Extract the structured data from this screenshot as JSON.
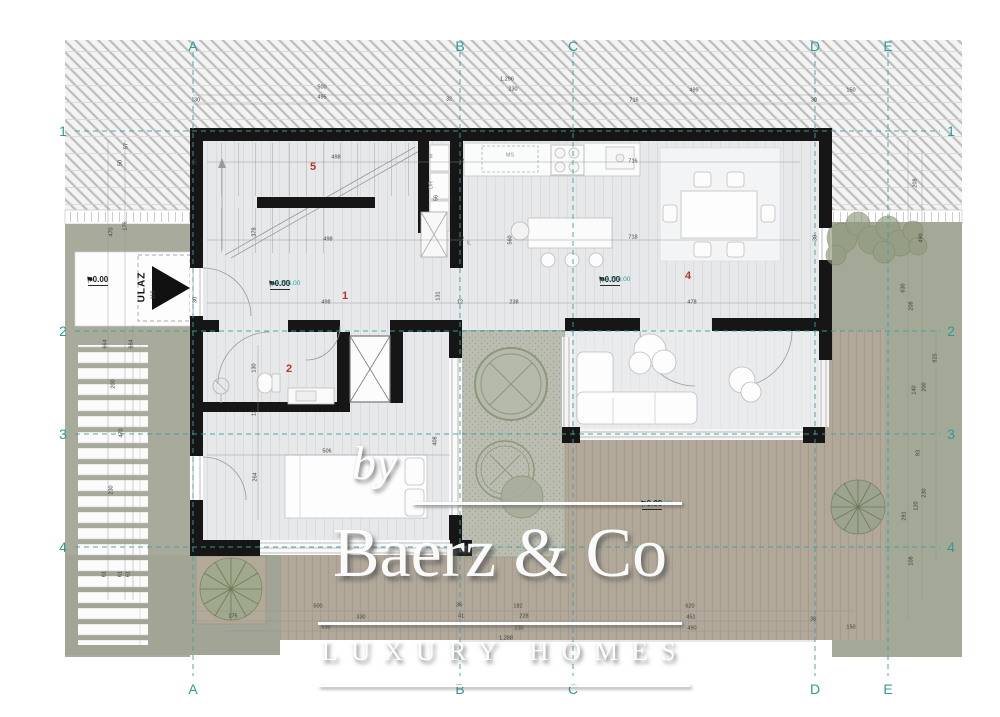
{
  "watermark": {
    "by": "by",
    "brand": "Baerz & Co",
    "tagline": "LUXURY HOMES"
  },
  "colors": {
    "grid_teal": "#2d9c96",
    "room_red": "#b0392f",
    "wall_black": "#161616",
    "grass": "#a8ab9b",
    "deck_tan": "#b2a89a",
    "floor_gray": "#e7e8ea",
    "elevation_teal": "#2d9c96"
  },
  "grid": {
    "top_y": 46,
    "bottom_y": 689,
    "left_x": 63,
    "right_x": 951,
    "columns": [
      {
        "label": "A",
        "x": 193
      },
      {
        "label": "B",
        "x": 460
      },
      {
        "label": "C",
        "x": 573
      },
      {
        "label": "D",
        "x": 815
      },
      {
        "label": "E",
        "x": 888
      }
    ],
    "rows": [
      {
        "label": "1",
        "y": 131
      },
      {
        "label": "2",
        "y": 331
      },
      {
        "label": "3",
        "y": 434
      },
      {
        "label": "4",
        "y": 547
      }
    ]
  },
  "entrance": {
    "label": "ULAZ",
    "x": 142,
    "y": 287
  },
  "room_numbers": [
    {
      "number": "5",
      "x": 313,
      "y": 167
    },
    {
      "number": "1",
      "x": 345,
      "y": 296
    },
    {
      "number": "2",
      "x": 289,
      "y": 369
    },
    {
      "number": "4",
      "x": 688,
      "y": 276
    }
  ],
  "elevation_markers": [
    {
      "value": "+0.00",
      "sub": "",
      "x": 86,
      "y": 276
    },
    {
      "value": "+0.00",
      "sub": "a.k.216.00",
      "x": 268,
      "y": 280
    },
    {
      "value": "+0.00",
      "sub": "a.k.216.00",
      "x": 598,
      "y": 276
    },
    {
      "value": "+0.00",
      "sub": "a.k.216.00",
      "x": 640,
      "y": 500
    }
  ],
  "small_labels": [
    {
      "t": "MS",
      "x": 510,
      "y": 156
    },
    {
      "t": "W",
      "x": 432,
      "y": 156,
      "rot": 1
    },
    {
      "t": "DR",
      "x": 432,
      "y": 185,
      "rot": 1
    },
    {
      "t": "IL",
      "x": 469,
      "y": 244
    }
  ],
  "dimensions": [
    {
      "t": "1,296",
      "x": 507,
      "y": 80
    },
    {
      "t": "230",
      "x": 513,
      "y": 90
    },
    {
      "t": "500",
      "x": 322,
      "y": 88
    },
    {
      "t": "495",
      "x": 322,
      "y": 98
    },
    {
      "t": "30",
      "x": 197,
      "y": 101
    },
    {
      "t": "32",
      "x": 449,
      "y": 100
    },
    {
      "t": "716",
      "x": 634,
      "y": 101
    },
    {
      "t": "499",
      "x": 694,
      "y": 91
    },
    {
      "t": "30",
      "x": 814,
      "y": 101
    },
    {
      "t": "150",
      "x": 851,
      "y": 91
    },
    {
      "t": "57",
      "x": 127,
      "y": 146,
      "rot": 1
    },
    {
      "t": "50",
      "x": 121,
      "y": 163,
      "rot": 1
    },
    {
      "t": "176",
      "x": 126,
      "y": 226,
      "rot": 1
    },
    {
      "t": "470",
      "x": 112,
      "y": 232,
      "rot": 1
    },
    {
      "t": "110",
      "x": 154,
      "y": 295,
      "rot": 1
    },
    {
      "t": "664",
      "x": 106,
      "y": 344,
      "rot": 1
    },
    {
      "t": "664",
      "x": 132,
      "y": 344,
      "rot": 1
    },
    {
      "t": "200",
      "x": 114,
      "y": 384,
      "rot": 1
    },
    {
      "t": "470",
      "x": 122,
      "y": 433,
      "rot": 1
    },
    {
      "t": "230",
      "x": 112,
      "y": 490,
      "rot": 1
    },
    {
      "t": "61",
      "x": 105,
      "y": 574,
      "rot": 1
    },
    {
      "t": "61",
      "x": 121,
      "y": 574,
      "rot": 1
    },
    {
      "t": "61",
      "x": 129,
      "y": 574,
      "rot": 1
    },
    {
      "t": "208",
      "x": 916,
      "y": 183,
      "rot": 1
    },
    {
      "t": "490",
      "x": 922,
      "y": 238,
      "rot": 1
    },
    {
      "t": "630",
      "x": 904,
      "y": 288,
      "rot": 1
    },
    {
      "t": "208",
      "x": 912,
      "y": 306,
      "rot": 1
    },
    {
      "t": "925",
      "x": 936,
      "y": 358,
      "rot": 1
    },
    {
      "t": "140",
      "x": 915,
      "y": 390,
      "rot": 1
    },
    {
      "t": "200",
      "x": 925,
      "y": 387,
      "rot": 1
    },
    {
      "t": "93",
      "x": 919,
      "y": 453,
      "rot": 1
    },
    {
      "t": "230",
      "x": 925,
      "y": 493,
      "rot": 1
    },
    {
      "t": "120",
      "x": 917,
      "y": 506,
      "rot": 1
    },
    {
      "t": "291",
      "x": 905,
      "y": 516,
      "rot": 1
    },
    {
      "t": "108",
      "x": 912,
      "y": 561,
      "rot": 1
    },
    {
      "t": "500",
      "x": 318,
      "y": 607
    },
    {
      "t": "36",
      "x": 459,
      "y": 606
    },
    {
      "t": "182",
      "x": 518,
      "y": 607
    },
    {
      "t": "620",
      "x": 690,
      "y": 607
    },
    {
      "t": "175",
      "x": 233,
      "y": 617
    },
    {
      "t": "330",
      "x": 361,
      "y": 618
    },
    {
      "t": "41",
      "x": 461,
      "y": 617
    },
    {
      "t": "228",
      "x": 524,
      "y": 617
    },
    {
      "t": "451",
      "x": 691,
      "y": 618
    },
    {
      "t": "530",
      "x": 326,
      "y": 628
    },
    {
      "t": "230",
      "x": 519,
      "y": 629
    },
    {
      "t": "490",
      "x": 692,
      "y": 629
    },
    {
      "t": "1,288",
      "x": 506,
      "y": 639
    },
    {
      "t": "38",
      "x": 813,
      "y": 620
    },
    {
      "t": "150",
      "x": 851,
      "y": 628
    },
    {
      "t": "498",
      "x": 336,
      "y": 158
    },
    {
      "t": "12",
      "x": 461,
      "y": 162
    },
    {
      "t": "716",
      "x": 633,
      "y": 162
    },
    {
      "t": "718",
      "x": 633,
      "y": 238
    },
    {
      "t": "560",
      "x": 511,
      "y": 240,
      "rot": 1
    },
    {
      "t": "378",
      "x": 255,
      "y": 232,
      "rot": 1
    },
    {
      "t": "498",
      "x": 328,
      "y": 240
    },
    {
      "t": "498",
      "x": 326,
      "y": 303
    },
    {
      "t": "131",
      "x": 439,
      "y": 296,
      "rot": 1
    },
    {
      "t": "12",
      "x": 461,
      "y": 240
    },
    {
      "t": "12",
      "x": 460,
      "y": 303
    },
    {
      "t": "238",
      "x": 514,
      "y": 303
    },
    {
      "t": "478",
      "x": 692,
      "y": 303
    },
    {
      "t": "30",
      "x": 196,
      "y": 162,
      "rot": 1
    },
    {
      "t": "30",
      "x": 196,
      "y": 300,
      "rot": 1
    },
    {
      "t": "30",
      "x": 816,
      "y": 238,
      "rot": 1
    },
    {
      "t": "56",
      "x": 437,
      "y": 198,
      "rot": 1
    },
    {
      "t": "506",
      "x": 327,
      "y": 452
    },
    {
      "t": "264",
      "x": 256,
      "y": 477,
      "rot": 1
    },
    {
      "t": "408",
      "x": 436,
      "y": 441,
      "rot": 1
    },
    {
      "t": "130",
      "x": 255,
      "y": 368,
      "rot": 1
    },
    {
      "t": "12",
      "x": 255,
      "y": 413,
      "rot": 1
    }
  ]
}
